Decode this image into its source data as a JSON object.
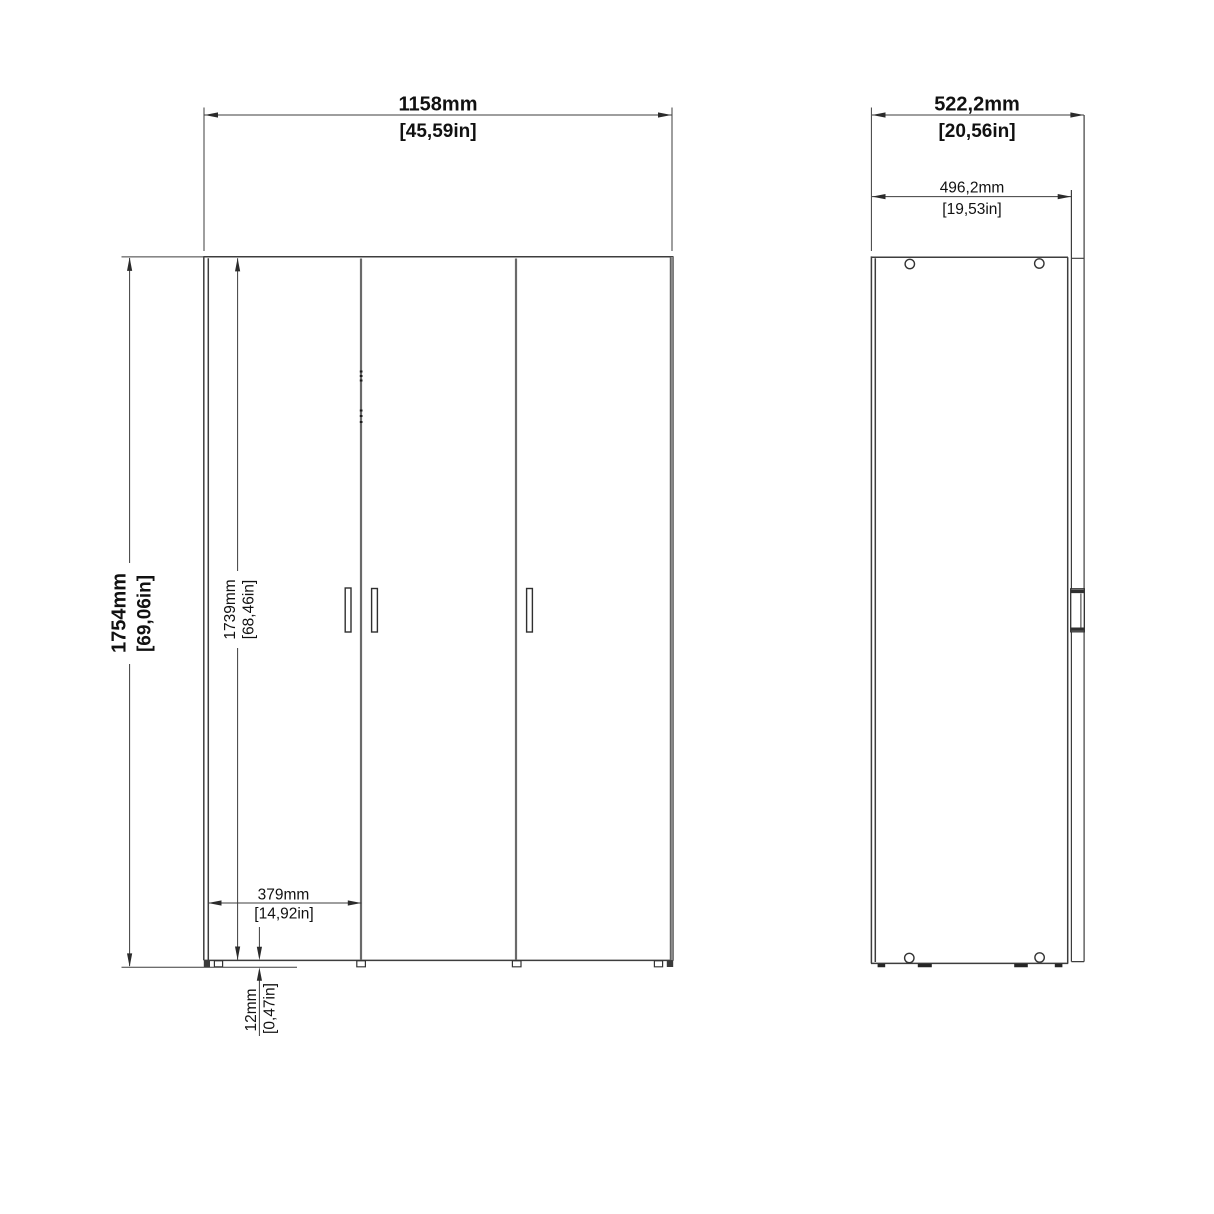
{
  "diagram": {
    "description": "three-door wardrobe dimension drawing, front and side views",
    "front_view": {
      "width_mm": "1158mm",
      "width_in": "[45,59in]",
      "height_mm": "1754mm",
      "height_in": "[69,06in]",
      "door_height_mm": "1739mm",
      "door_height_in": "[68,46in]",
      "door_width_mm": "379mm",
      "door_width_in": "[14,92in]",
      "plinth_height_mm": "12mm",
      "plinth_height_in": "[0,47in]"
    },
    "side_view": {
      "depth_mm": "522,2mm",
      "depth_in": "[20,56in]",
      "body_depth_mm": "496,2mm",
      "body_depth_in": "[19,53in]"
    },
    "colors": {
      "line": "#3d3d3d",
      "text": "#111111",
      "background": "#ffffff"
    }
  }
}
